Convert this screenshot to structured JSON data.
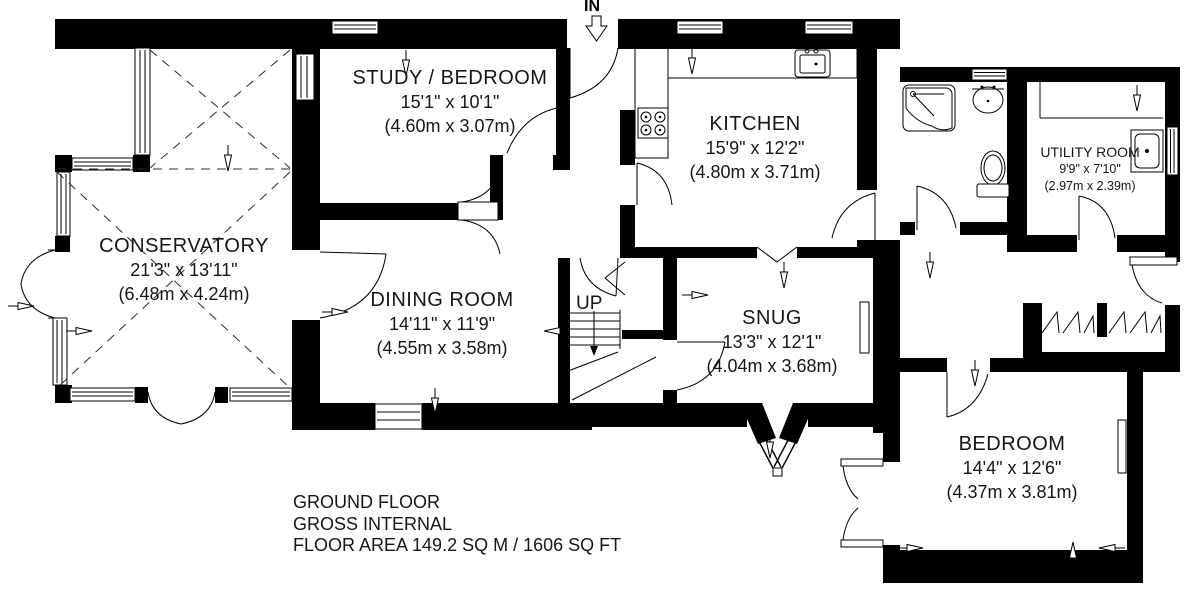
{
  "plan": {
    "entrance_label": "IN",
    "stairs_label": "UP",
    "rooms": {
      "conservatory": {
        "name": "CONSERVATORY",
        "imperial": "21'3\" x 13'11\"",
        "metric": "(6.48m x 4.24m)"
      },
      "study_bedroom": {
        "name": "STUDY / BEDROOM",
        "imperial": "15'1\" x 10'1\"",
        "metric": "(4.60m x 3.07m)"
      },
      "kitchen": {
        "name": "KITCHEN",
        "imperial": "15'9\" x 12'2\"",
        "metric": "(4.80m x 3.71m)"
      },
      "dining_room": {
        "name": "DINING ROOM",
        "imperial": "14'11\" x 11'9\"",
        "metric": "(4.55m x 3.58m)"
      },
      "snug": {
        "name": "SNUG",
        "imperial": "13'3\" x 12'1\"",
        "metric": "(4.04m x 3.68m)"
      },
      "utility_room": {
        "name": "UTILITY ROOM",
        "imperial": "9'9\" x 7'10\"",
        "metric": "(2.97m x 2.39m)"
      },
      "bedroom": {
        "name": "BEDROOM",
        "imperial": "14'4\" x 12'6\"",
        "metric": "(4.37m x 3.81m)"
      }
    },
    "footer": {
      "line1": "GROUND FLOOR",
      "line2": "GROSS INTERNAL",
      "line3": "FLOOR AREA 149.2 SQ M / 1606 SQ FT"
    },
    "colors": {
      "wall": "#000000",
      "background": "#ffffff",
      "line": "#161616"
    }
  }
}
